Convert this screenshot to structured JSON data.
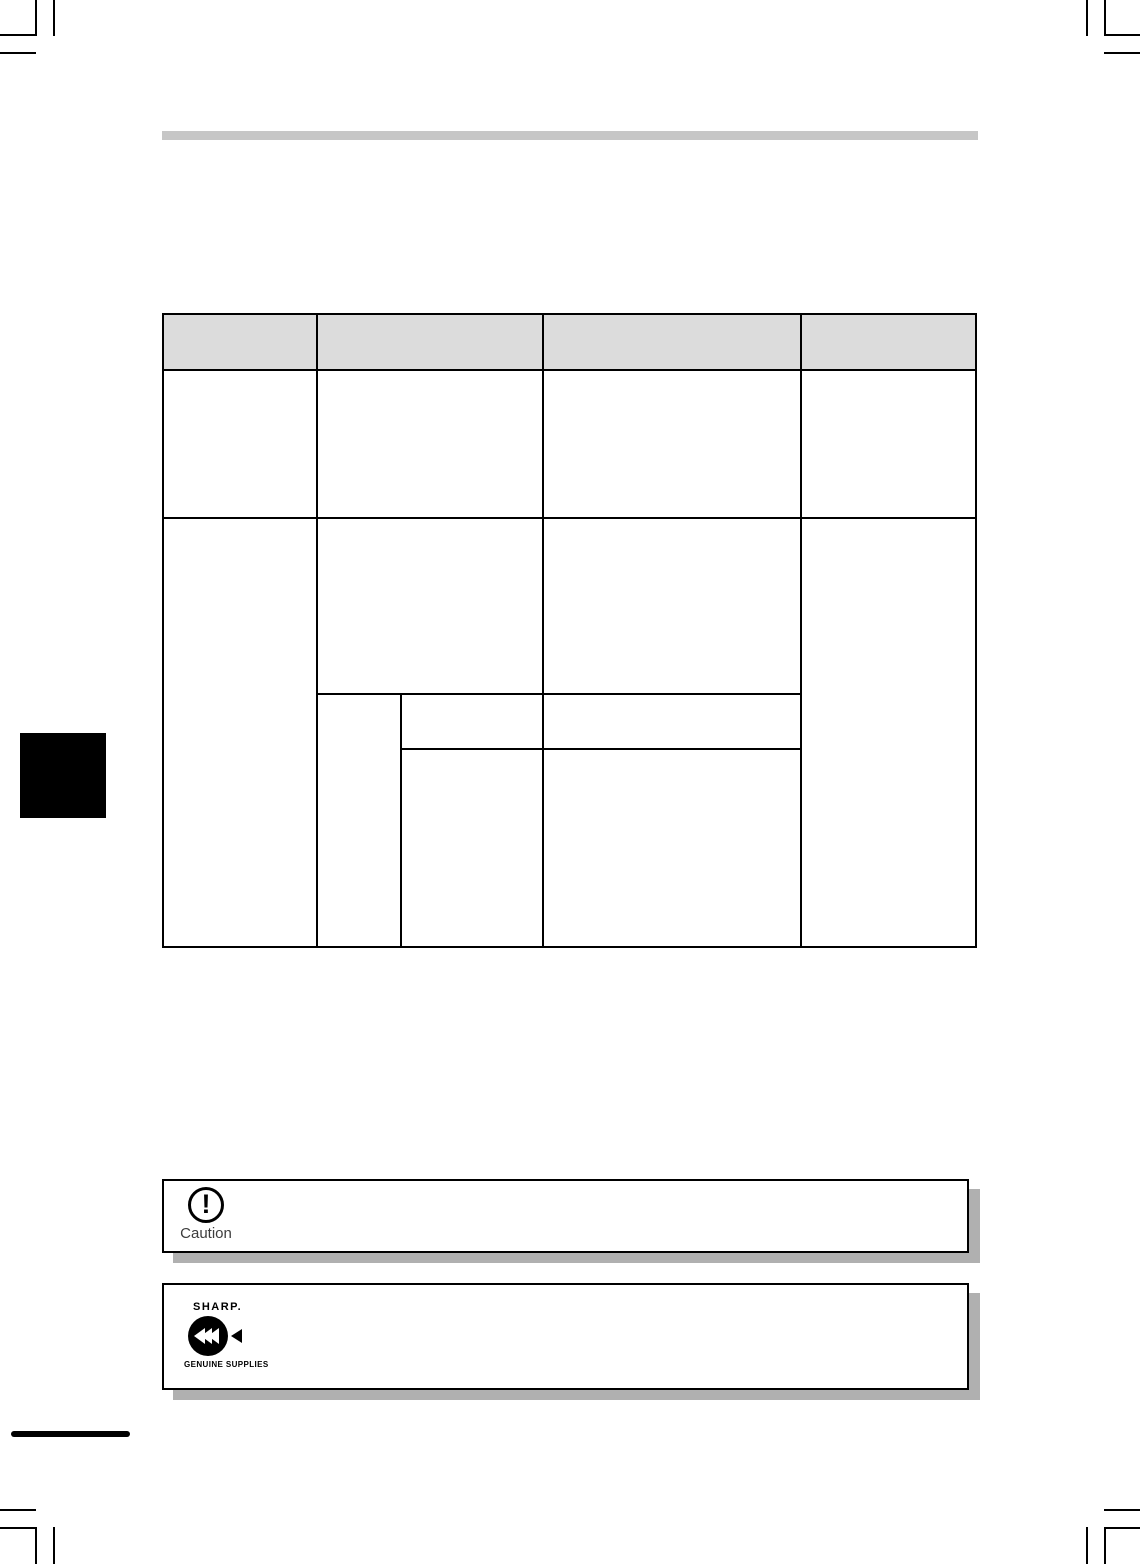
{
  "colors": {
    "table_header_fill": "#dcdcdc",
    "top_bar": "#c6c6c6",
    "shadow": "#b0b0b0",
    "line": "#000000",
    "caution_text": "#3c3c3c"
  },
  "table": {
    "header_cells": [
      "",
      "",
      "",
      ""
    ]
  },
  "caution_box": {
    "label": "Caution",
    "icon": "exclamation-circle-icon"
  },
  "supplies_box": {
    "brand": "SHARP.",
    "caption": "GENUINE SUPPLIES",
    "icon": "rewind-arrows-icon"
  }
}
